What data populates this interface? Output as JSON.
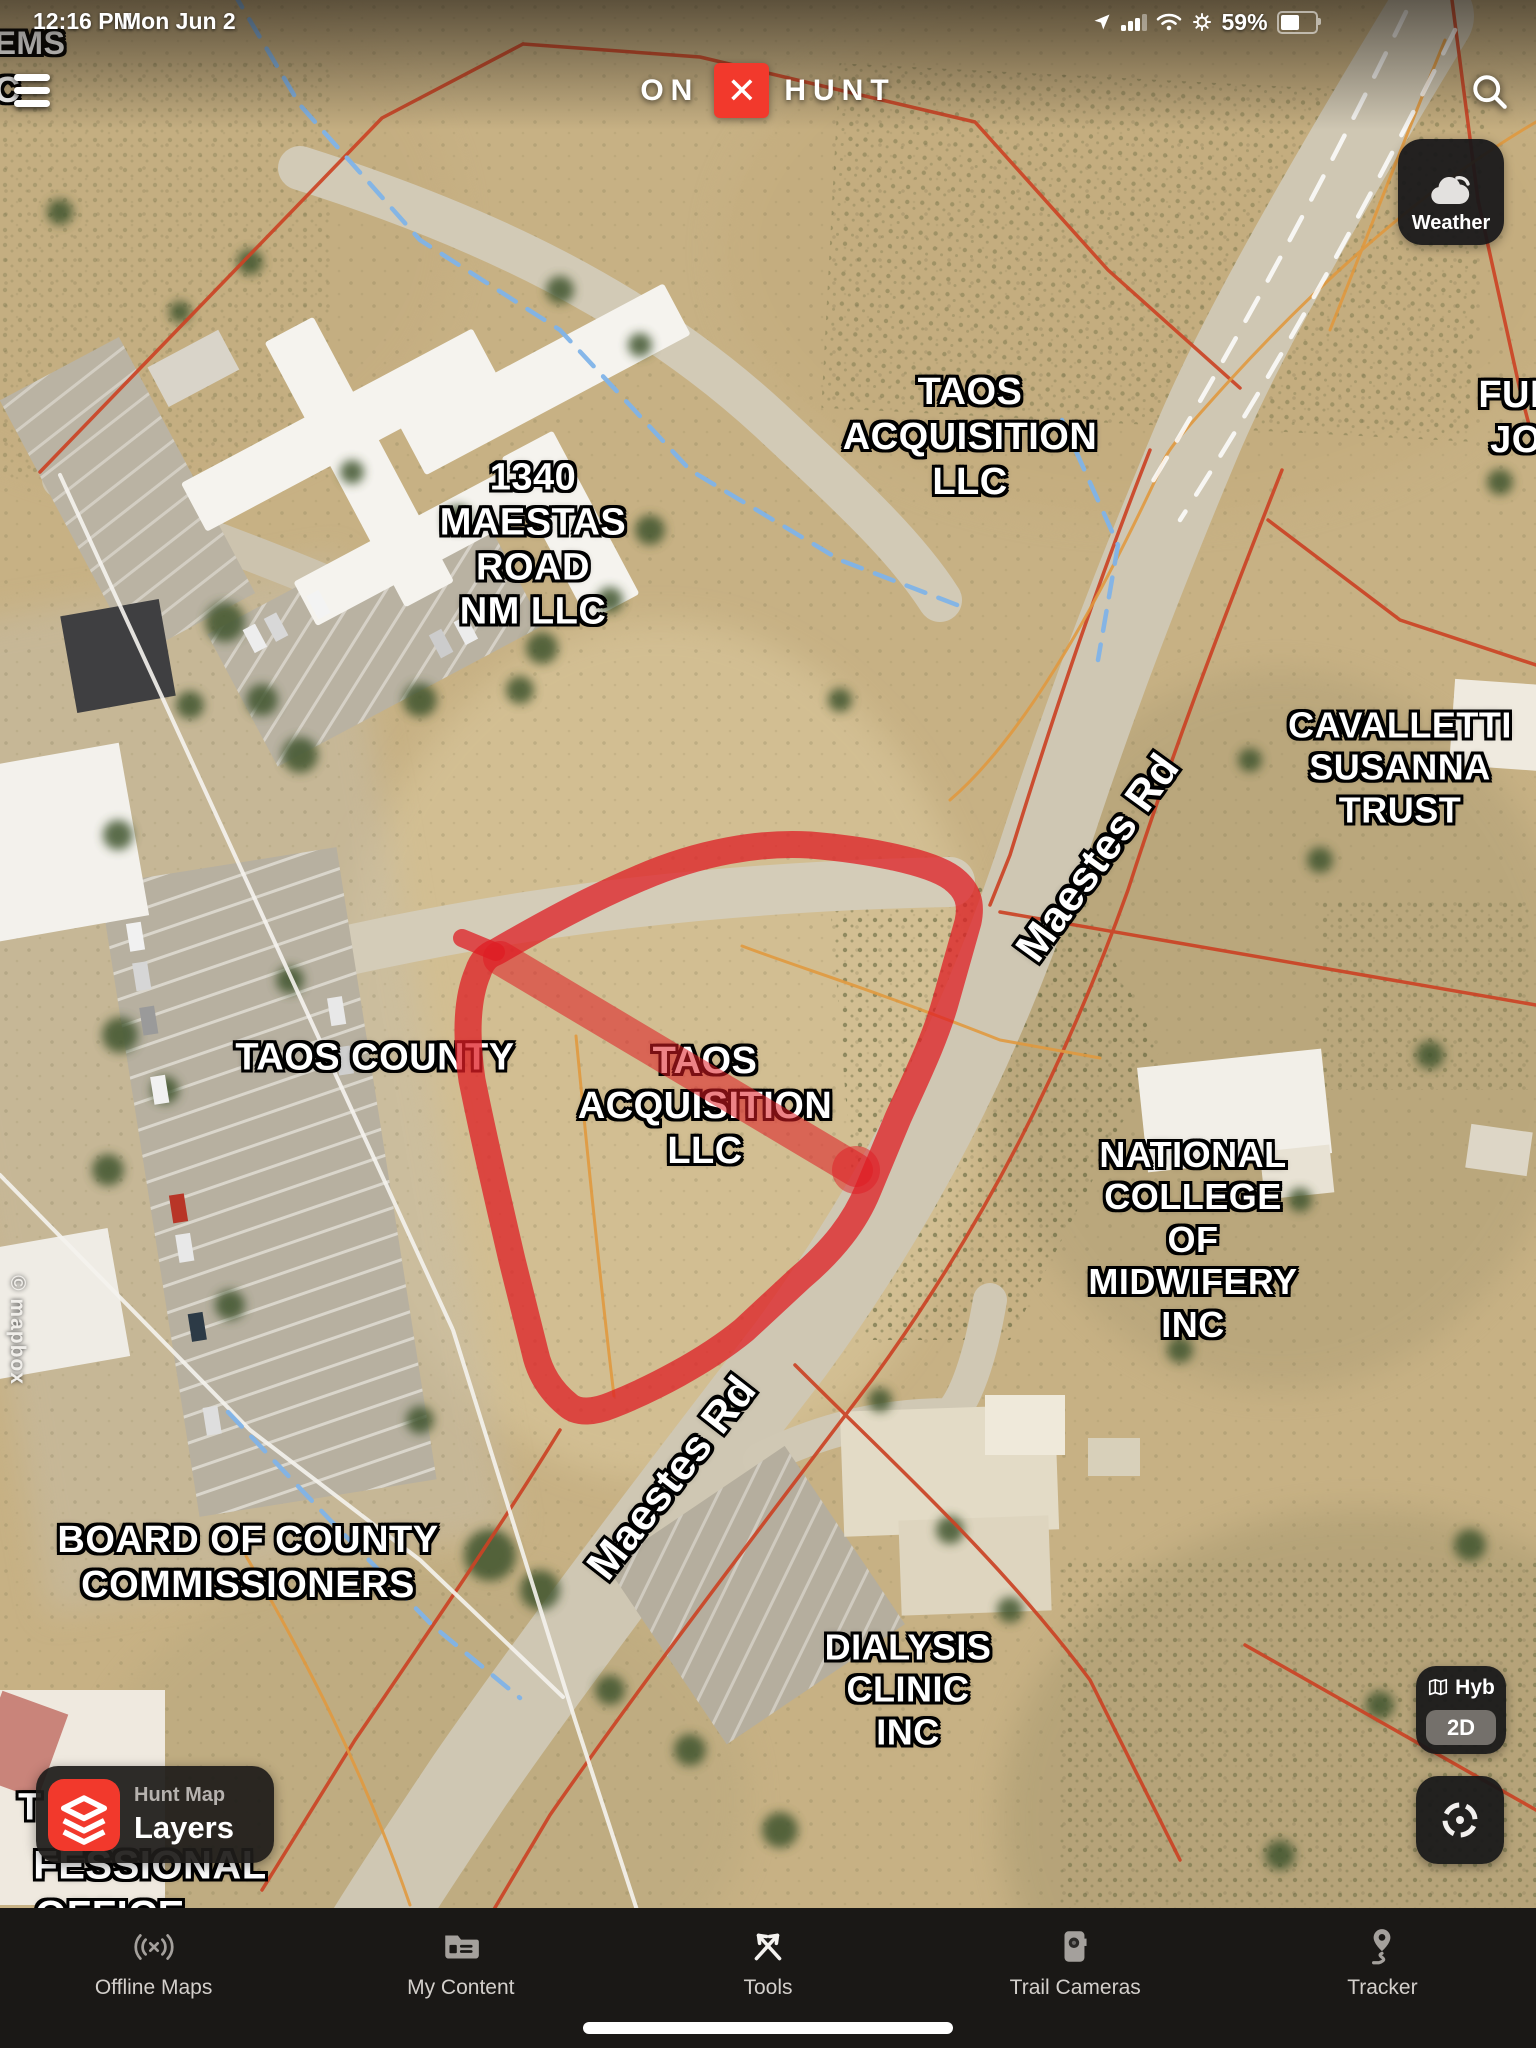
{
  "status_bar": {
    "time": "12:16 PM",
    "date": "Mon Jun 2",
    "battery_percent": "59%",
    "battery_level": 0.58,
    "icons": [
      "location-arrow-icon",
      "cellular-signal-icon",
      "wifi-icon",
      "gear-icon",
      "battery-icon"
    ]
  },
  "top_bar": {
    "logo_on": "ON",
    "logo_x_glyph": "✕",
    "logo_hunt": "HUNT",
    "search_icon": "search-icon"
  },
  "weather_button": {
    "label": "Weather",
    "icon": "cloud-sun-icon"
  },
  "map_controls": {
    "basemap_label": "Hyb",
    "basemap_icon": "map-icon",
    "dimension_label": "2D",
    "compass_icon": "crosshair-icon"
  },
  "layers_button": {
    "line1": "Hunt Map",
    "line2": "Layers",
    "icon": "layers-icon"
  },
  "attribution": {
    "text": "© mapbox"
  },
  "map_labels": [
    {
      "id": "ems",
      "text": "EMS",
      "x": 30,
      "y": 44,
      "size": 32,
      "rot": 0
    },
    {
      "id": "ic",
      "text": "IC",
      "x": 2,
      "y": 90,
      "size": 36,
      "rot": 0
    },
    {
      "id": "taos-acq-north",
      "text": "TAOS\nACQUISITION\nLLC",
      "x": 970,
      "y": 437,
      "size": 38,
      "rot": 0
    },
    {
      "id": "ful",
      "text": "FUL\nJO",
      "x": 1516,
      "y": 418,
      "size": 38,
      "rot": 0
    },
    {
      "id": "maestas-1340",
      "text": "1340\nMAESTAS\nROAD\nNM LLC",
      "x": 533,
      "y": 545,
      "size": 38,
      "rot": 0
    },
    {
      "id": "cavalletti",
      "text": "CAVALLETTI\nSUSANNA\nTRUST",
      "x": 1400,
      "y": 768,
      "size": 36,
      "rot": 0
    },
    {
      "id": "maestes-rd-1",
      "text": "Maestes Rd",
      "x": 1098,
      "y": 858,
      "size": 43,
      "rot": -54
    },
    {
      "id": "taos-county",
      "text": "TAOS COUNTY",
      "x": 375,
      "y": 1058,
      "size": 38,
      "rot": 0
    },
    {
      "id": "taos-acq-parcel",
      "text": "TAOS\nACQUISITION\nLLC",
      "x": 705,
      "y": 1106,
      "size": 38,
      "rot": 0
    },
    {
      "id": "natl-college",
      "text": "NATIONAL\nCOLLEGE\nOF\nMIDWIFERY\nINC",
      "x": 1193,
      "y": 1240,
      "size": 36,
      "rot": 0
    },
    {
      "id": "maestes-rd-2",
      "text": "Maestes Rd",
      "x": 672,
      "y": 1478,
      "size": 43,
      "rot": -52
    },
    {
      "id": "board-county",
      "text": "BOARD OF COUNTY\nCOMMISSIONERS",
      "x": 248,
      "y": 1563,
      "size": 38,
      "rot": 0
    },
    {
      "id": "dialysis",
      "text": "DIALYSIS\nCLINIC\nINC",
      "x": 908,
      "y": 1690,
      "size": 36,
      "rot": 0
    },
    {
      "id": "t-partial",
      "text": "T",
      "x": 30,
      "y": 1808,
      "size": 38,
      "rot": 0
    },
    {
      "id": "fessional",
      "text": "FESSIONAL",
      "x": 150,
      "y": 1866,
      "size": 40,
      "rot": 0
    },
    {
      "id": "office",
      "text": "OFFICE",
      "x": 110,
      "y": 1916,
      "size": 40,
      "rot": 0
    }
  ],
  "tab_bar": {
    "items": [
      {
        "label": "Offline Maps",
        "icon": "offline-maps-icon",
        "active": false
      },
      {
        "label": "My Content",
        "icon": "my-content-icon",
        "active": false
      },
      {
        "label": "Tools",
        "icon": "tools-icon",
        "active": true
      },
      {
        "label": "Trail Cameras",
        "icon": "trail-cameras-icon",
        "active": false
      },
      {
        "label": "Tracker",
        "icon": "tracker-icon",
        "active": false
      }
    ]
  },
  "colors": {
    "brand_red": "#f2392c",
    "parcel_highlight_red": "#e01c23",
    "parcel_line_red": "#cb4325",
    "boundary_orange": "#e0993f",
    "water_blue": "#7fb3e8",
    "panel_dark": "#1a1816",
    "label_white": "#ffffff"
  }
}
